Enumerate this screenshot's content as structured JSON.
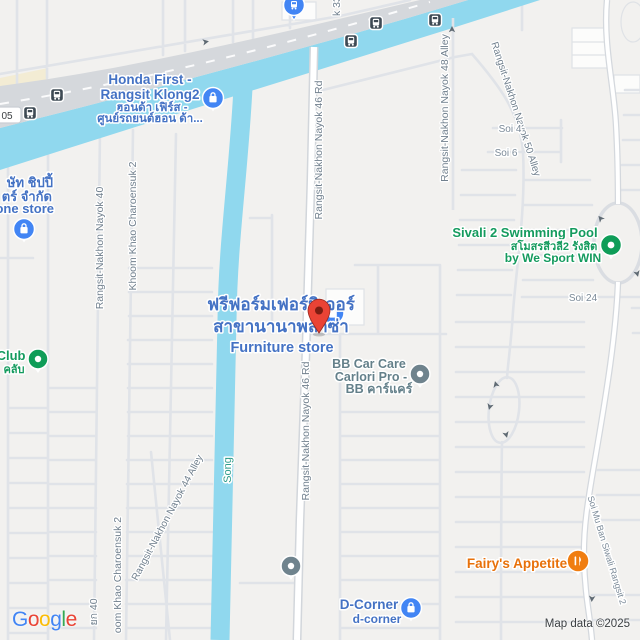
{
  "map": {
    "attribution": "Map data ©2025",
    "colors": {
      "land": "#f2f1ef",
      "water": "#90d8ee",
      "highway": "#d5d8dc",
      "minor_road": "#e0e3e8",
      "poi_blue": "#4285f4",
      "poi_green": "#0f9d58",
      "poi_orange": "#f07d10",
      "poi_gray": "#6f838d",
      "marker_red": "#ea4335",
      "label_blue": "#4472c4",
      "label_green": "#149b5e",
      "label_orange": "#e8710a",
      "label_gray_teal": "#64808a",
      "road_label": "#71808e",
      "water_label": "#2e9c8a"
    }
  },
  "logo": {
    "letters": [
      {
        "ch": "G"
      },
      {
        "ch": "o"
      },
      {
        "ch": "o"
      },
      {
        "ch": "g"
      },
      {
        "ch": "l"
      },
      {
        "ch": "e"
      }
    ]
  },
  "pois": {
    "honda": {
      "line1": "Honda First -",
      "line2": "Rangsit Klong2",
      "line3": "ฮอนด้า เฟิร์ส -",
      "line4": "ศูนย์รถยนต์ฮอน ด้า..."
    },
    "phone_store": {
      "line1": "ษัท ชิปปี้",
      "line2": "ตร์ จำกัด",
      "line3": "hone store"
    },
    "furniture": {
      "line1": "ฟรีฟอร์มเฟอร์นิเจอร์",
      "line2": "สาขานานาพลาซ่า",
      "line3": "Furniture store"
    },
    "bb_car_care": {
      "line1": "BB Car Care",
      "line2": "Carlori Pro -",
      "line3": "BB คาร์แคร์"
    },
    "sivali": {
      "line1": "Sivali 2 Swimming Pool",
      "line2": "สโมสรสีวลี2 รังสิต",
      "line3": "by We Sport WIN"
    },
    "club": {
      "line1": "Club",
      "line2": "คลับ"
    },
    "d_corner": {
      "line1": "D-Corner",
      "line2": "d-corner"
    },
    "fairys": {
      "line1": "Fairy's Appetite"
    }
  },
  "roads": {
    "r46_top": "Rangsit-Nakhon Nayok 46 Rd",
    "r46_bottom": "Rangsit-Nakhon Nayok 46 Rd",
    "r40": "Rangsit-Nakhon Nayok 40",
    "r40_thai": "ยก 40",
    "charoensuk_top": "Khoom Khao Charoensuk 2",
    "charoensuk_bottom": "oom Khao Charoensuk 2",
    "r44": "Rangsit-Nakhon Nayok 44 Alley",
    "r48": "Rangsit-Nakhon Nayok 48 Alley",
    "r50": "Rangsit-Nakhon Nayok 50 Alley",
    "r33": "k 33",
    "soi4": "Soi 4",
    "soi6": "Soi 6",
    "soi24": "Soi 24",
    "siwali_soi": "Soi Mu Ban Siwali Rangsit 2",
    "song": "Song",
    "route_badge": "05"
  }
}
